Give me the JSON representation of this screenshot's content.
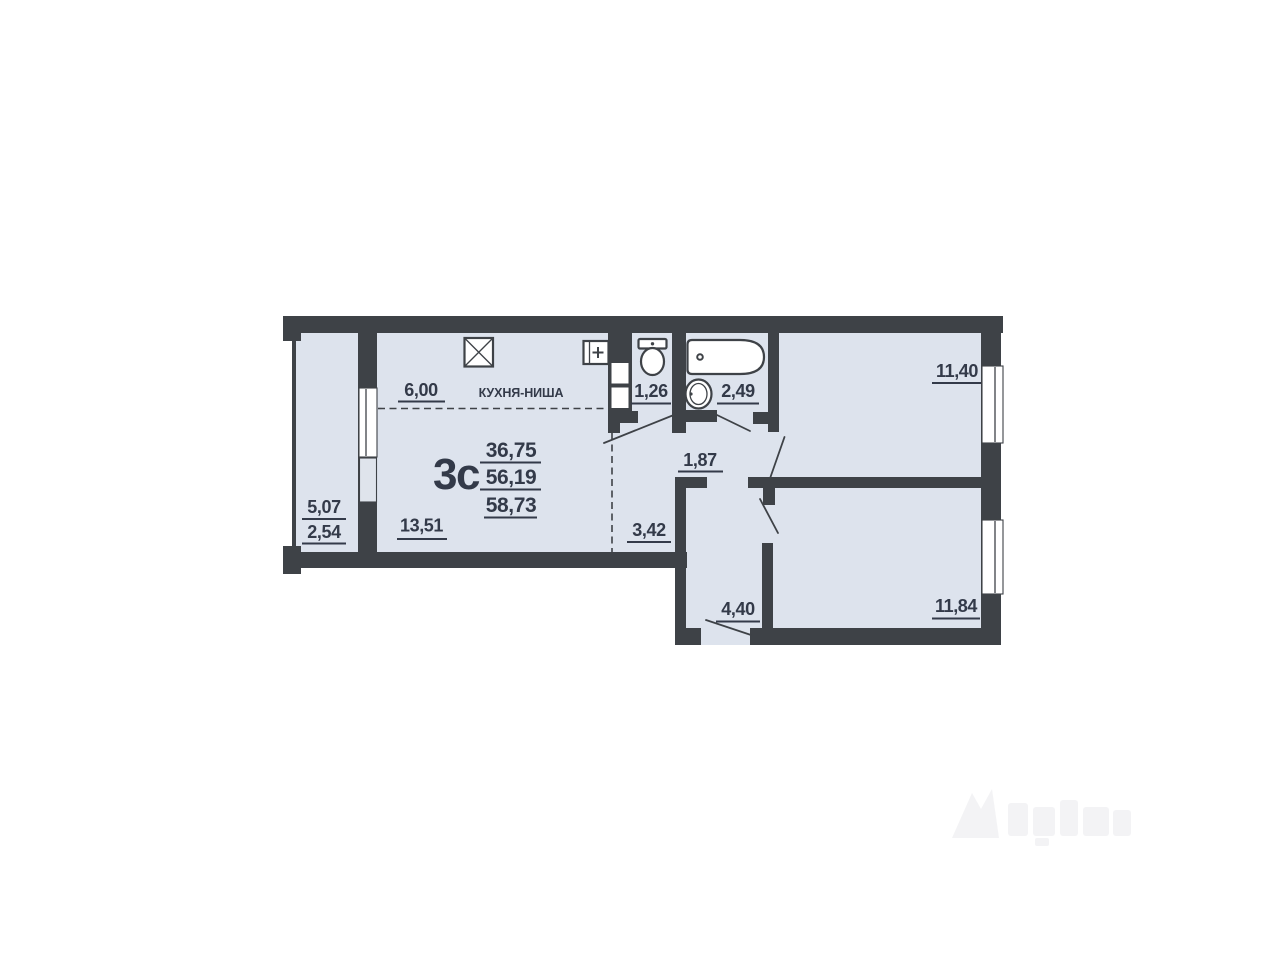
{
  "floorplan": {
    "apartment_type": "3с",
    "area_summary": {
      "living": "36,75",
      "total": "56,19",
      "total_with_balcony": "58,73"
    },
    "labels": {
      "kitchen_niche": "КУХНЯ-НИША",
      "kitchen_width": "6,00",
      "living_room_area": "13,51",
      "balcony_area_full": "5,07",
      "balcony_area_reduced": "2,54",
      "wc_area": "1,26",
      "bathroom_area": "2,49",
      "hall_area": "1,87",
      "corridor_area": "3,42",
      "entrance_hall_area": "4,40",
      "bedroom_top_area": "11,40",
      "bedroom_bottom_area": "11,84"
    },
    "icons": [
      "stove-icon",
      "electrical-panel-icon",
      "vent-shaft",
      "toilet-icon",
      "bathtub-icon",
      "sink-icon"
    ],
    "colors": {
      "wall": "#3e4247",
      "room_fill": "#dde3ed",
      "label_text": "#333a49",
      "window_white": "#ffffff",
      "background": "#ffffff"
    }
  }
}
